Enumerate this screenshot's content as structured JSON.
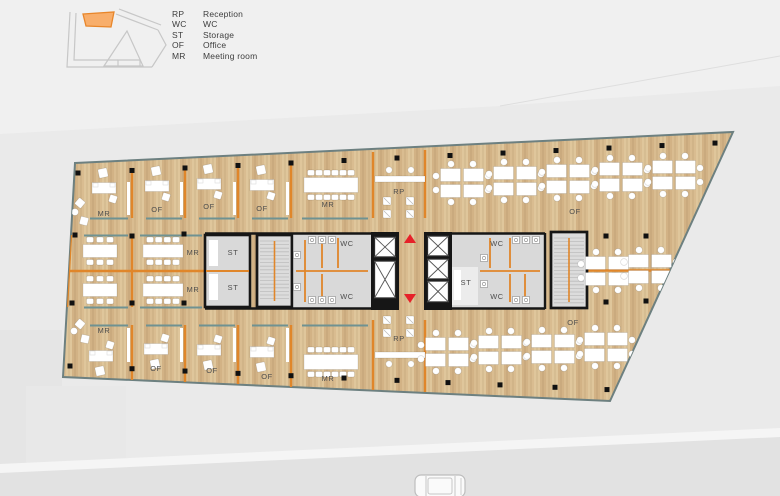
{
  "page": {
    "background": "#eaeaea"
  },
  "legend": {
    "items": [
      {
        "abbr": "RP",
        "label": "Reception"
      },
      {
        "abbr": "WC",
        "label": "WC"
      },
      {
        "abbr": "ST",
        "label": "Storage"
      },
      {
        "abbr": "OF",
        "label": "Office"
      },
      {
        "abbr": "MR",
        "label": "Meeting room"
      }
    ]
  },
  "key_plan": {
    "highlight_fill": "#f8ae6b",
    "highlight_stroke": "#e8862a",
    "outline_color": "#c7c7c7"
  },
  "plan": {
    "colors": {
      "bg": "#eaeaea",
      "wood": "#d9bc90",
      "wood_dark": "#d2b285",
      "wood_light": "#dfc69b",
      "orange": "#e0862a",
      "teal": "#6f9292",
      "gray_core": "#d9d9d9",
      "black_wall": "#161616",
      "red": "#e62129",
      "furniture": "#ffffff",
      "outline": "#6d8080"
    },
    "labels": [
      {
        "text": "MR",
        "x": 104,
        "y": 216
      },
      {
        "text": "OF",
        "x": 157,
        "y": 212
      },
      {
        "text": "OF",
        "x": 209,
        "y": 209
      },
      {
        "text": "OF",
        "x": 262,
        "y": 211
      },
      {
        "text": "MR",
        "x": 328,
        "y": 207
      },
      {
        "text": "RP",
        "x": 399,
        "y": 194
      },
      {
        "text": "OF",
        "x": 575,
        "y": 214
      },
      {
        "text": "MR",
        "x": 193,
        "y": 255
      },
      {
        "text": "MR",
        "x": 193,
        "y": 292
      },
      {
        "text": "ST",
        "x": 233,
        "y": 255
      },
      {
        "text": "ST",
        "x": 233,
        "y": 290
      },
      {
        "text": "WC",
        "x": 347,
        "y": 246
      },
      {
        "text": "WC",
        "x": 347,
        "y": 299
      },
      {
        "text": "ST",
        "x": 466,
        "y": 285
      },
      {
        "text": "WC",
        "x": 497,
        "y": 246
      },
      {
        "text": "WC",
        "x": 497,
        "y": 299
      },
      {
        "text": "MR",
        "x": 104,
        "y": 333
      },
      {
        "text": "OF",
        "x": 156,
        "y": 371
      },
      {
        "text": "OF",
        "x": 212,
        "y": 373
      },
      {
        "text": "OF",
        "x": 267,
        "y": 379
      },
      {
        "text": "MR",
        "x": 328,
        "y": 381
      },
      {
        "text": "RP",
        "x": 399,
        "y": 341
      },
      {
        "text": "OF",
        "x": 573,
        "y": 325
      }
    ]
  }
}
